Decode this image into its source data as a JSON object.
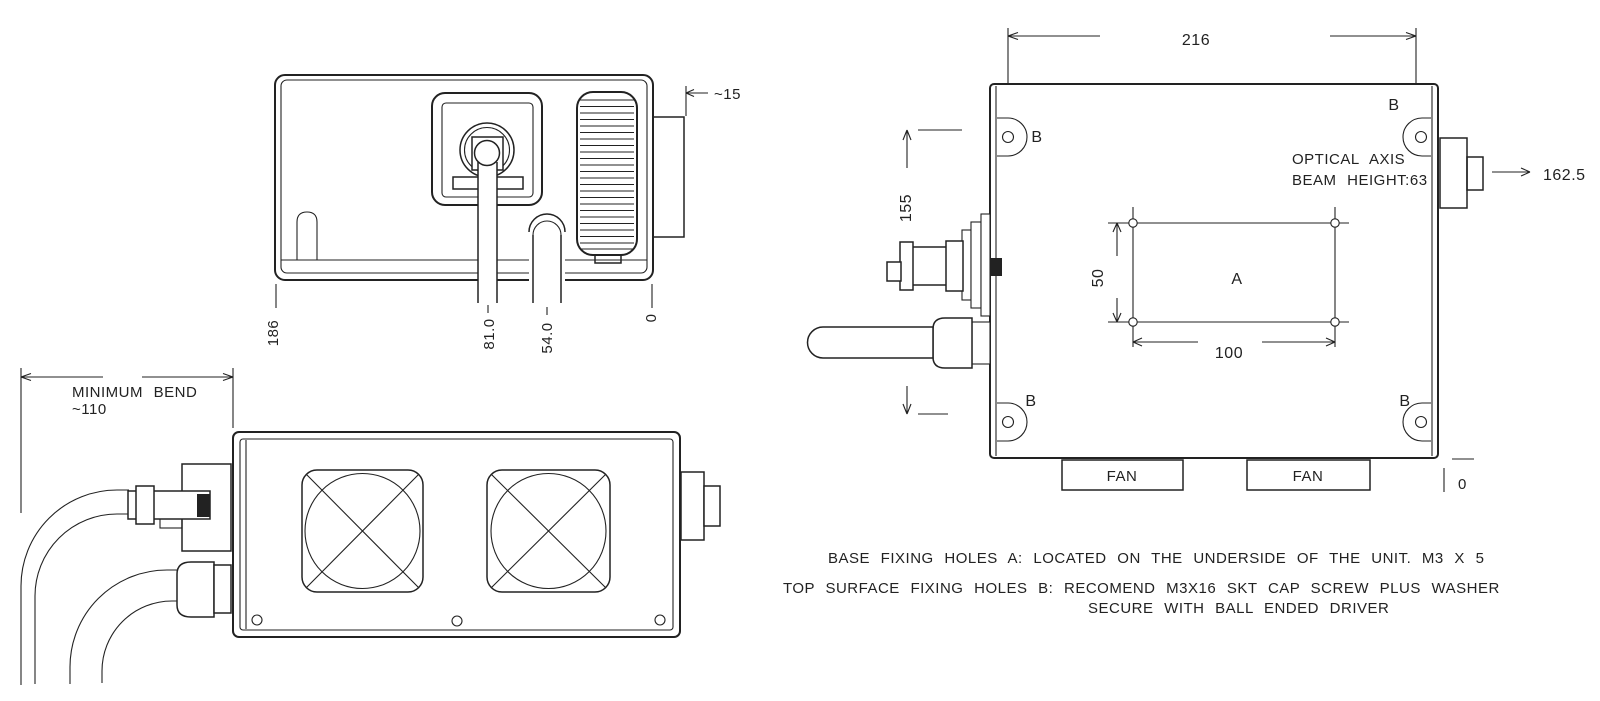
{
  "colors": {
    "line": "#222222",
    "background": "#ffffff"
  },
  "front_view": {
    "dim_width": "186",
    "dim_port": "81.0",
    "dim_cable": "54.0",
    "dim_zero": "0",
    "dim_flange": "~15"
  },
  "top_view": {
    "min_bend_label": "MINIMUM BEND",
    "min_bend_value": "~110"
  },
  "side_view": {
    "dim_width": "216",
    "dim_height": "155",
    "dim_connector": "162.5",
    "dim_zero": "0",
    "optical_axis_line1": "OPTICAL AXIS",
    "optical_axis_line2": "BEAM HEIGHT:63",
    "hole_a_label": "A",
    "hole_b_label": "B",
    "dim_holes_vertical": "50",
    "dim_holes_horizontal": "100",
    "fan_label": "FAN"
  },
  "notes": {
    "base_holes": "BASE FIXING HOLES A: LOCATED ON THE UNDERSIDE OF THE UNIT. M3 X 5",
    "top_holes_1": "TOP SURFACE FIXING HOLES B: RECOMEND M3X16 SKT CAP SCREW PLUS WASHER",
    "top_holes_2": "SECURE WITH BALL ENDED DRIVER"
  }
}
